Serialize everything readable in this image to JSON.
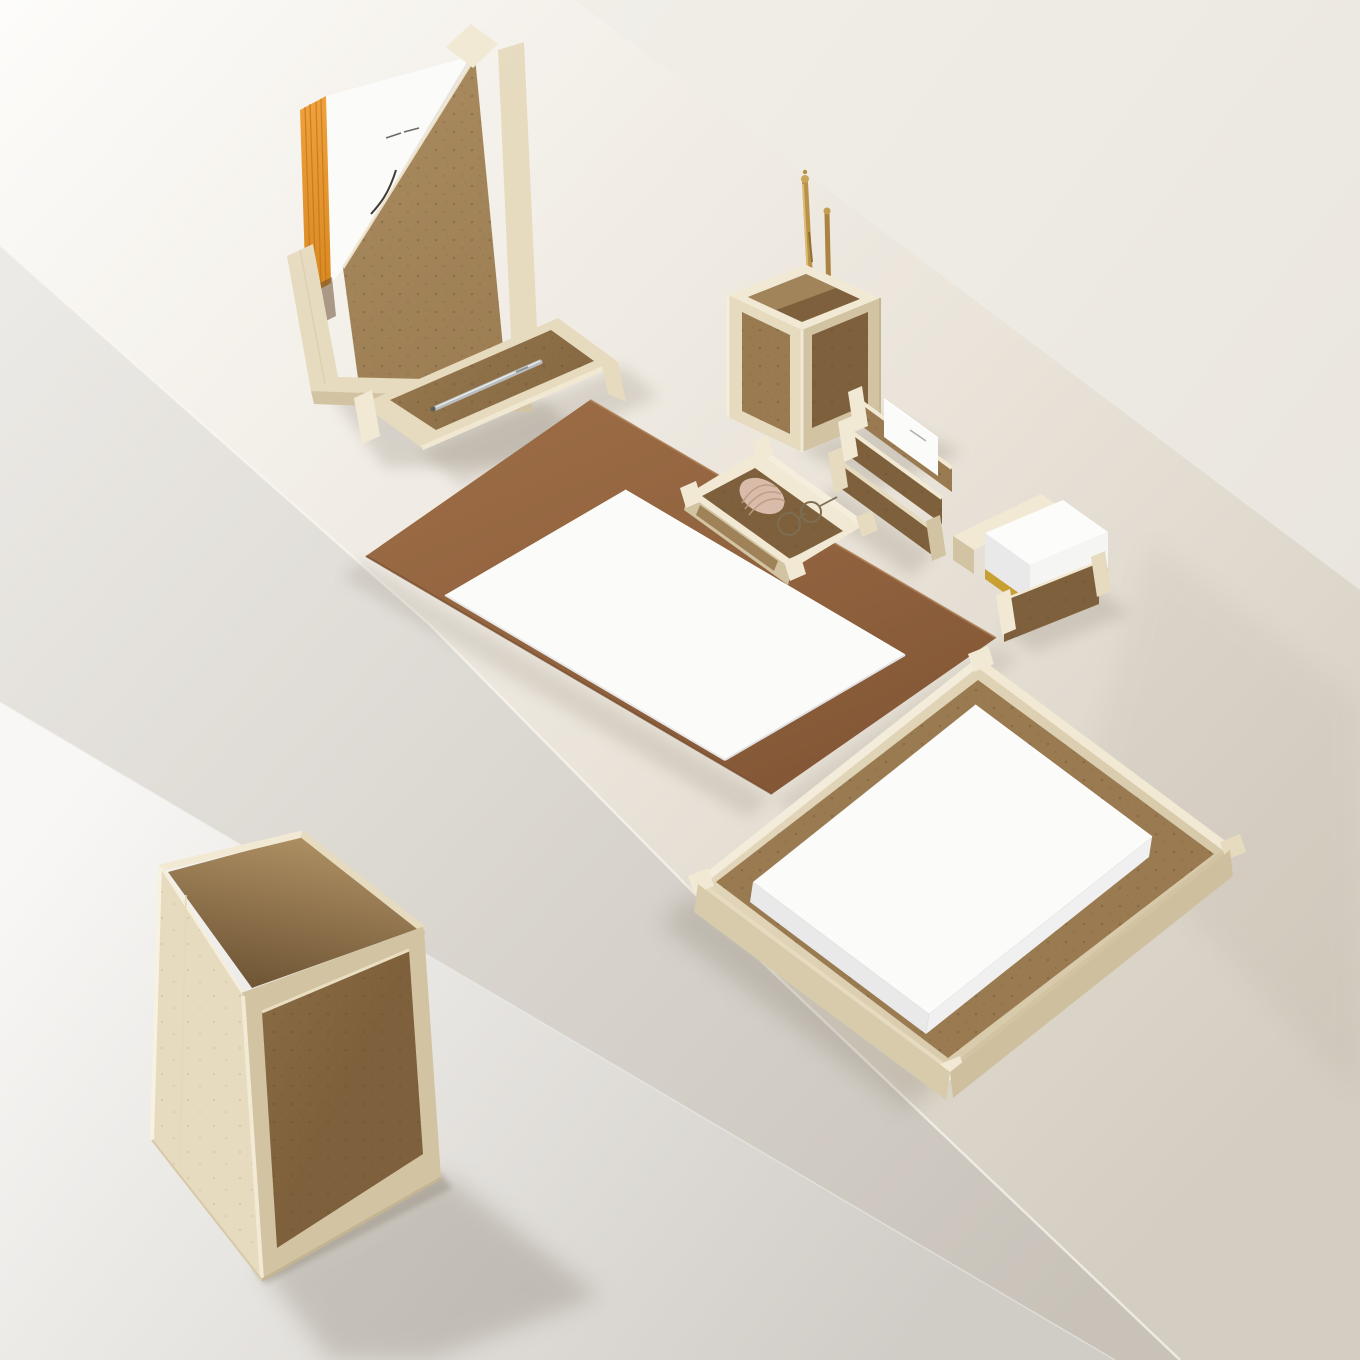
{
  "scene": {
    "description": "Overhead product photo of a beige travertine and cork desk set arranged on a white plinth: magazine file with catalogue, pen tray, pencil cup with brass pens, brown suede desk pad with white sheet, accessory tray with shell and eyeglasses, letter holder with cards, memo-paper holder with yellow-edged notes, document tray with paper stack, and a waste bin on the floor below."
  },
  "items": [
    {
      "id": "magazine-file",
      "label": "Magazine file with white catalogue and orange page edges"
    },
    {
      "id": "pen-tray",
      "label": "Pen tray with silver pen"
    },
    {
      "id": "pencil-cup",
      "label": "Pencil cup with brass pens"
    },
    {
      "id": "desk-pad",
      "label": "Brown suede desk pad with white paper sheet"
    },
    {
      "id": "accessory-tray",
      "label": "Accessory tray with seashell and wire eyeglasses"
    },
    {
      "id": "letter-holder",
      "label": "Letter holder with white cards"
    },
    {
      "id": "memo-holder",
      "label": "Memo paper holder with yellow-bottomed note stack"
    },
    {
      "id": "paper-tray",
      "label": "Document tray with stack of white paper"
    },
    {
      "id": "waste-bin",
      "label": "Travertine waste paper bin"
    }
  ],
  "palette": {
    "wall": "#f1eee8",
    "wall_dark": "#eae6df",
    "top_light": "#fdfcfa",
    "top_mid": "#eae4da",
    "top_dark": "#d4cdc1",
    "face_light": "#eceae6",
    "face_dark": "#c8c2b9",
    "floor_light": "#f8f7f5",
    "floor_dark": "#d0ccc6",
    "travertine_light": "#f2e9d4",
    "travertine": "#e6dabf",
    "travertine_shade": "#d2c4a3",
    "travertine_deep": "#c4b593",
    "cork_light": "#ab8d61",
    "cork": "#9a7b51",
    "cork_dark": "#7e613c",
    "cork_deep": "#6b5132",
    "suede_light": "#9a6b44",
    "suede": "#8d5f3c",
    "suede_dark": "#784e2f",
    "paper": "#fbfbfa",
    "paper_shade": "#e9e9ea",
    "orange": "#efa13d",
    "orange_dark": "#d8871f",
    "brass": "#b8914a",
    "silver": "#b9bdbf",
    "yellow": "#e2ae35",
    "shell_pink": "#d9bba9",
    "wire": "#7d6d52",
    "shadow": "#6f6553"
  }
}
